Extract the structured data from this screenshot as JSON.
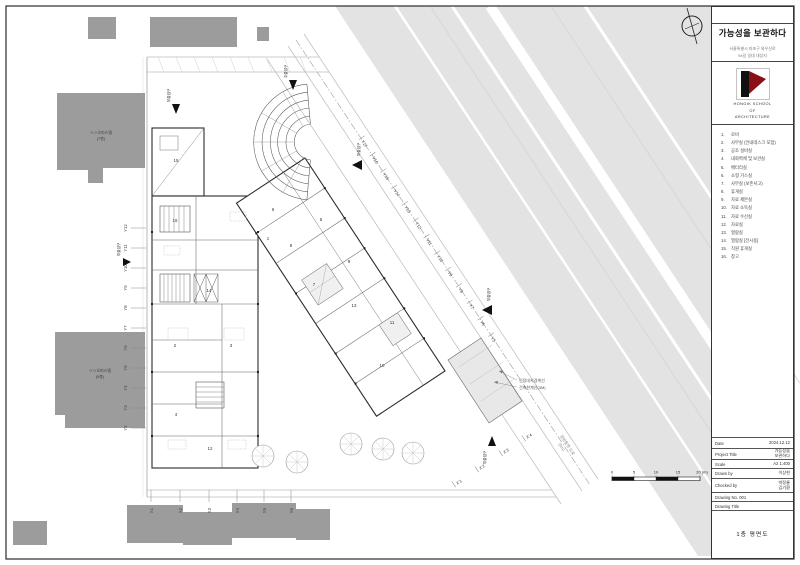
{
  "sheet": {
    "title": "가능성을 보관하다",
    "address1": "서울특별시 마포구 와우산로",
    "address2": "94길 일대 대상지"
  },
  "logo": {
    "line1": "HONGIK  SCHOOL",
    "line2": "OF",
    "line3": "ARCHITECTURE",
    "red": "#8a1016",
    "black": "#111111"
  },
  "legend": {
    "items": [
      {
        "no": "1.",
        "label": "로비"
      },
      {
        "no": "2.",
        "label": "사무실 (안내데스크 포함)"
      },
      {
        "no": "3.",
        "label": "공조 설비실"
      },
      {
        "no": "4.",
        "label": "내화벽체 및 보관실"
      },
      {
        "no": "5.",
        "label": "배터리실"
      },
      {
        "no": "6.",
        "label": "소형 가스실"
      },
      {
        "no": "7.",
        "label": "사무실 (보존서고)"
      },
      {
        "no": "8.",
        "label": "휴게실"
      },
      {
        "no": "9.",
        "label": "자료 제본실"
      },
      {
        "no": "10.",
        "label": "자료 소독실"
      },
      {
        "no": "11.",
        "label": "자료 수선실"
      },
      {
        "no": "12.",
        "label": "자료실"
      },
      {
        "no": "13.",
        "label": "열람실"
      },
      {
        "no": "14.",
        "label": "열람실 [전시용]"
      },
      {
        "no": "15.",
        "label": "직원 휴게실"
      },
      {
        "no": "16.",
        "label": "창고"
      }
    ]
  },
  "titleblock": {
    "date_label": "Date",
    "date": "2024.12.12",
    "project_label": "Project  Title",
    "project1": "가능성을",
    "project2": "보관하다",
    "scale_label": "Scale",
    "scale": "A2  1:400",
    "drawn_label": "Drawn  by",
    "drawn": "이상현",
    "checked_label": "Checked  by",
    "checked1": "박정룡",
    "checked2": "김기환",
    "no_label": "Drawing  No.  001",
    "title_label": "Drawing  Title",
    "drawing_title": "1층 평면도"
  },
  "plan": {
    "grid_left": [
      "Y12",
      "Y11",
      "Y10",
      "Y9",
      "Y8",
      "Y7",
      "Y6",
      "Y5",
      "Y4",
      "Y3",
      "Y2"
    ],
    "grid_bottom": [
      "X1",
      "X2",
      "X3",
      "X4",
      "X5",
      "X6"
    ],
    "grid_street": [
      "Y17",
      "Y16",
      "Y15",
      "Y14",
      "Y13",
      "Y12",
      "Y11",
      "Y10",
      "Y9",
      "Y8",
      "Y7",
      "Y6",
      "Y5"
    ],
    "grid_diag": [
      "X'1",
      "X'2",
      "X'3",
      "X'4"
    ],
    "rooms": [
      "1",
      "2",
      "3",
      "4",
      "5",
      "6",
      "7",
      "8",
      "9",
      "10",
      "11",
      "12",
      "13",
      "14",
      "15",
      "16"
    ],
    "entrances": {
      "main": "주출입구",
      "sub": "부출입구"
    },
    "neighbors": [
      {
        "name": "ㅇㅇ오피스텔",
        "floors": "(7층)"
      },
      {
        "name": "ㅇㅇ오피스텔",
        "floors": "(5층)"
      }
    ],
    "annotations": {
      "boundary": "인접대지경계선",
      "setback": "건축한계선(3M)",
      "road": "일방통행 도로",
      "road_w": "(6m)"
    },
    "scalebar": [
      "0",
      "5",
      "10",
      "15",
      "20 (m)"
    ]
  }
}
